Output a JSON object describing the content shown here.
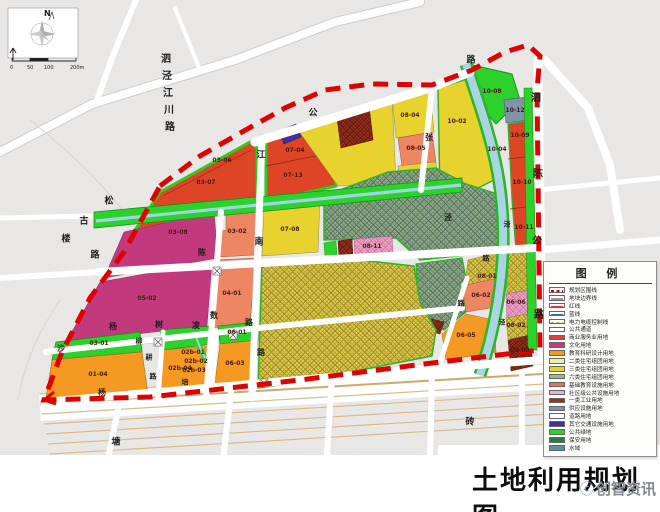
{
  "title": "土地利用规划图",
  "watermark": {
    "icon": "ⓒ",
    "text": "创智资讯"
  },
  "compass": {
    "north_label": "N"
  },
  "scalebar": {
    "ticks": [
      "0",
      "50",
      "100",
      "200m"
    ]
  },
  "legend": {
    "title": "图 例",
    "items": [
      {
        "label": "规划区围线",
        "style": "line-dash",
        "color": "#e10000"
      },
      {
        "label": "地块边界线",
        "style": "line",
        "color": "#9a9a9a"
      },
      {
        "label": "红线",
        "style": "line",
        "color": "#e03838"
      },
      {
        "label": "蓝线",
        "style": "line",
        "color": "#3c5cd0"
      },
      {
        "label": "电力电缆控制线",
        "style": "line-dash",
        "color": "#c2b23a"
      },
      {
        "label": "公共通道",
        "style": "box",
        "color": "#ffffff"
      },
      {
        "label": "商业服务业用地",
        "style": "box",
        "color": "#d84048"
      },
      {
        "label": "文化用地",
        "style": "box",
        "color": "#c23a7d"
      },
      {
        "label": "教育科研设计用地",
        "style": "box",
        "color": "#f49a23"
      },
      {
        "label": "二类住宅组团用地",
        "style": "box",
        "color": "#f6eda0"
      },
      {
        "label": "三类住宅组团用地",
        "style": "box",
        "color": "#e8d22e"
      },
      {
        "label": "六类住宅组团用地",
        "style": "box-hatch",
        "color": "#9cbb78"
      },
      {
        "label": "基础教育设施用地",
        "style": "box-hatch",
        "color": "#e8705a"
      },
      {
        "label": "社区级公共设施用地",
        "style": "box-hatch",
        "color": "#f3abc9"
      },
      {
        "label": "一类工业用地",
        "style": "box-hatch",
        "color": "#97311e"
      },
      {
        "label": "供应设施用地",
        "style": "box",
        "color": "#8193a8"
      },
      {
        "label": "道路用地",
        "style": "box",
        "color": "#ffffff"
      },
      {
        "label": "其它交通设施用地",
        "style": "box",
        "color": "#42309a"
      },
      {
        "label": "公共绿地",
        "style": "box",
        "color": "#2cd12c"
      },
      {
        "label": "保安用地",
        "style": "box",
        "color": "#2a7a3a"
      },
      {
        "label": "水域",
        "style": "box",
        "color": "#54939e"
      }
    ]
  },
  "map": {
    "boundary_color": "#e10000",
    "parcel_labels": [
      {
        "t": "03-04",
        "x": 222,
        "y": 161
      },
      {
        "t": "03-07",
        "x": 206,
        "y": 183
      },
      {
        "t": "07-04",
        "x": 295,
        "y": 151
      },
      {
        "t": "07-13",
        "x": 293,
        "y": 176
      },
      {
        "t": "08-04",
        "x": 410,
        "y": 116
      },
      {
        "t": "08-05",
        "x": 416,
        "y": 149
      },
      {
        "t": "10-02",
        "x": 457,
        "y": 122
      },
      {
        "t": "10-08",
        "x": 492,
        "y": 92
      },
      {
        "t": "10-12",
        "x": 515,
        "y": 111
      },
      {
        "t": "10-09",
        "x": 520,
        "y": 136
      },
      {
        "t": "10-04",
        "x": 497,
        "y": 150
      },
      {
        "t": "10-10",
        "x": 522,
        "y": 183
      },
      {
        "t": "10-11",
        "x": 524,
        "y": 228
      },
      {
        "t": "03-08",
        "x": 178,
        "y": 233
      },
      {
        "t": "03-02",
        "x": 237,
        "y": 232
      },
      {
        "t": "07-08",
        "x": 290,
        "y": 230
      },
      {
        "t": "08-11",
        "x": 372,
        "y": 247
      },
      {
        "t": "05-02",
        "x": 147,
        "y": 299
      },
      {
        "t": "04-01",
        "x": 232,
        "y": 294
      },
      {
        "t": "08-01",
        "x": 487,
        "y": 277
      },
      {
        "t": "06-02",
        "x": 481,
        "y": 296
      },
      {
        "t": "06-05",
        "x": 466,
        "y": 336
      },
      {
        "t": "06-06",
        "x": 516,
        "y": 303
      },
      {
        "t": "08-02",
        "x": 516,
        "y": 326
      },
      {
        "t": "06-08",
        "x": 520,
        "y": 351
      },
      {
        "t": "03-01",
        "x": 99,
        "y": 344
      },
      {
        "t": "01-04",
        "x": 98,
        "y": 375
      },
      {
        "t": "02b-01",
        "x": 193,
        "y": 353
      },
      {
        "t": "02b-02",
        "x": 196,
        "y": 362
      },
      {
        "t": "02b-03",
        "x": 194,
        "y": 371
      },
      {
        "t": "02b-04",
        "x": 180,
        "y": 369
      },
      {
        "t": "06-01",
        "x": 237,
        "y": 333
      },
      {
        "t": "06-03",
        "x": 235,
        "y": 364
      }
    ],
    "road_labels": [
      {
        "t": "泗",
        "x": 166,
        "y": 60,
        "s": 10
      },
      {
        "t": "泾",
        "x": 167,
        "y": 77,
        "s": 10
      },
      {
        "t": "江",
        "x": 168,
        "y": 94,
        "s": 10
      },
      {
        "t": "川",
        "x": 169,
        "y": 111,
        "s": 10
      },
      {
        "t": "路",
        "x": 170,
        "y": 128,
        "s": 10
      },
      {
        "t": "公",
        "x": 313,
        "y": 114,
        "s": 9
      },
      {
        "t": "路",
        "x": 471,
        "y": 61,
        "s": 9
      },
      {
        "t": "泗",
        "x": 536,
        "y": 99,
        "s": 10
      },
      {
        "t": "陈",
        "x": 538,
        "y": 175,
        "s": 10
      },
      {
        "t": "公",
        "x": 537,
        "y": 242,
        "s": 10
      },
      {
        "t": "路",
        "x": 539,
        "y": 316,
        "s": 10
      },
      {
        "t": "古",
        "x": 84,
        "y": 222,
        "s": 9
      },
      {
        "t": "楼",
        "x": 66,
        "y": 240,
        "s": 9
      },
      {
        "t": "路",
        "x": 95,
        "y": 256,
        "s": 9
      },
      {
        "t": "松",
        "x": 109,
        "y": 202,
        "s": 9
      },
      {
        "t": "陈",
        "x": 202,
        "y": 253,
        "s": 8
      },
      {
        "t": "数",
        "x": 214,
        "y": 316,
        "s": 8
      },
      {
        "t": "江",
        "x": 261,
        "y": 156,
        "s": 9
      },
      {
        "t": "南",
        "x": 259,
        "y": 243,
        "s": 9
      },
      {
        "t": "路",
        "x": 261,
        "y": 353,
        "s": 8
      },
      {
        "t": "杨",
        "x": 113,
        "y": 327,
        "s": 8
      },
      {
        "t": "树",
        "x": 159,
        "y": 325,
        "s": 8
      },
      {
        "t": "凌",
        "x": 196,
        "y": 326,
        "s": 8
      },
      {
        "t": "路",
        "x": 249,
        "y": 323,
        "s": 8
      },
      {
        "t": "柳",
        "x": 139,
        "y": 342,
        "s": 7
      },
      {
        "t": "耕",
        "x": 149,
        "y": 358,
        "s": 7
      },
      {
        "t": "路",
        "x": 153,
        "y": 377,
        "s": 7
      },
      {
        "t": "培",
        "x": 185,
        "y": 383,
        "s": 7
      },
      {
        "t": "沙",
        "x": 61,
        "y": 349,
        "s": 8
      },
      {
        "t": "杨",
        "x": 102,
        "y": 393,
        "s": 8
      },
      {
        "t": "塘",
        "x": 116,
        "y": 443,
        "s": 9
      },
      {
        "t": "砖",
        "x": 470,
        "y": 423,
        "s": 9
      },
      {
        "t": "张",
        "x": 429,
        "y": 138,
        "s": 8
      },
      {
        "t": "泾",
        "x": 448,
        "y": 218,
        "s": 8
      },
      {
        "t": "泾",
        "x": 507,
        "y": 225,
        "s": 7
      },
      {
        "t": "泾",
        "x": 502,
        "y": 323,
        "s": 7
      },
      {
        "t": "路",
        "x": 461,
        "y": 304,
        "s": 7
      },
      {
        "t": "路",
        "x": 486,
        "y": 259,
        "s": 7
      }
    ]
  }
}
